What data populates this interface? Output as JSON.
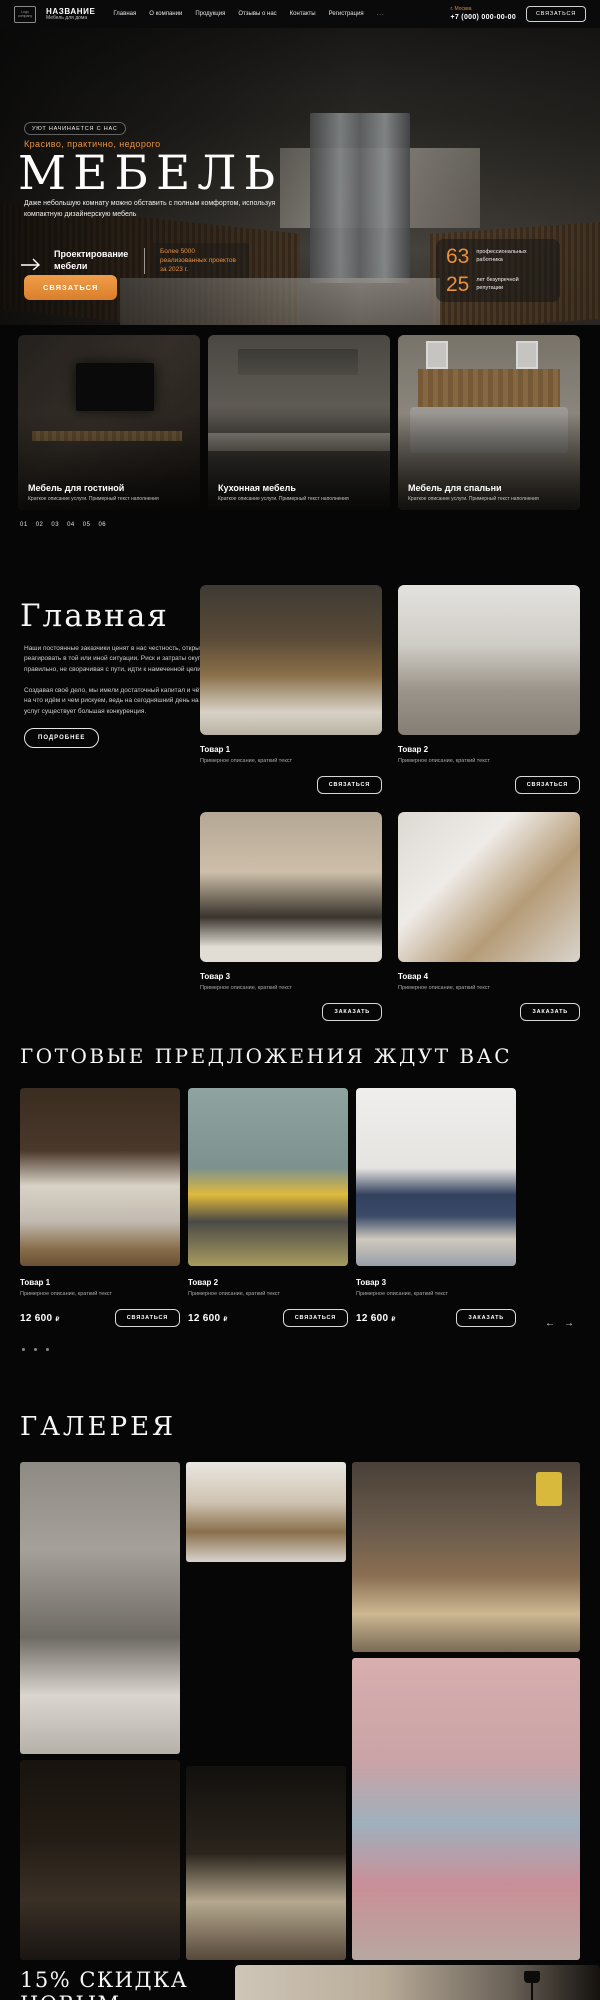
{
  "colors": {
    "accent": "#E8913D",
    "background": "#060606"
  },
  "header": {
    "logo_box": "Logo company",
    "brand_name": "НАЗВАНИЕ",
    "brand_tagline": "Мебель для дома",
    "nav": [
      "Главная",
      "О компании",
      "Продукция",
      "Отзывы о нас",
      "Контакты",
      "Регистрация",
      "..."
    ],
    "city": "г. Москва",
    "phone": "+7 (000) 000-00-00",
    "contact_button": "СВЯЗАТЬСЯ"
  },
  "hero": {
    "badge": "УЮТ НАЧИНАЕТСЯ С НАС",
    "tagline": "Красиво, практично, недорого",
    "title": "МЕБЕЛЬ",
    "description": "Даже небольшую комнату можно обставить с полным комфортом, используя компактную дизайнерскую мебель",
    "feature_title": "Проектирование мебели",
    "feature_note": "Более 5000 реализованных проектов за 2023 г.",
    "stats": [
      {
        "value": "63",
        "label": "профессиональных работника"
      },
      {
        "value": "25",
        "label": "лет безупречной репутации"
      }
    ],
    "cta_button": "СВЯЗАТЬСЯ",
    "prev_arrow": "←",
    "next_arrow": "→"
  },
  "categories": {
    "cards": [
      {
        "title": "Мебель для гостиной",
        "subtitle": "Краткое описание услуги. Примерный текст наполнения"
      },
      {
        "title": "Кухонная мебель",
        "subtitle": "Краткое описание услуги. Примерный текст наполнения"
      },
      {
        "title": "Мебель для спальни",
        "subtitle": "Краткое описание услуги. Примерный текст наполнения"
      }
    ],
    "pagination": [
      "01",
      "02",
      "03",
      "04",
      "05",
      "06"
    ]
  },
  "about": {
    "title": "Главная",
    "paragraph1": "Наши постоянные заказчики ценят в нас честность, открытость, умение оперативно реагировать в той или иной ситуации. Риск и затраты окупаются с лихвой, если правильно, не сворачивая с пути, идти к намеченной цели.",
    "paragraph2": "Создавая своё дело, мы имели достаточный капитал и чёткий план действий и знали, на что идём и чем рискуем, ведь на сегодняшний день на рынке идентичных товаров и услуг существует большая конкуренция.",
    "more_button": "ПОДРОБНЕЕ",
    "products": [
      {
        "name": "Товар 1",
        "description": "Примерное описание, краткий текст",
        "button": "СВЯЗАТЬСЯ"
      },
      {
        "name": "Товар 2",
        "description": "Примерное описание, краткий текст",
        "button": "СВЯЗАТЬСЯ"
      },
      {
        "name": "Товар 3",
        "description": "Примерное описание, краткий текст",
        "button": "ЗАКАЗАТЬ"
      },
      {
        "name": "Товар 4",
        "description": "Примерное описание, краткий текст",
        "button": "ЗАКАЗАТЬ"
      }
    ]
  },
  "offers": {
    "title": "ГОТОВЫЕ ПРЕДЛОЖЕНИЯ ЖДУТ ВАС",
    "items": [
      {
        "name": "Товар 1",
        "description": "Примерное описание, краткий текст",
        "price": "12 600",
        "currency": "₽",
        "button": "СВЯЗАТЬСЯ"
      },
      {
        "name": "Товар 2",
        "description": "Примерное описание, краткий текст",
        "price": "12 600",
        "currency": "₽",
        "button": "СВЯЗАТЬСЯ"
      },
      {
        "name": "Товар 3",
        "description": "Примерное описание, краткий текст",
        "price": "12 600",
        "currency": "₽",
        "button": "ЗАКАЗАТЬ"
      }
    ],
    "prev_arrow": "←",
    "next_arrow": "→"
  },
  "gallery": {
    "title": "ГАЛЕРЕЯ"
  },
  "promo": {
    "title": "15% СКИДКА НОВЫМ КЛИЕНТАМ"
  }
}
